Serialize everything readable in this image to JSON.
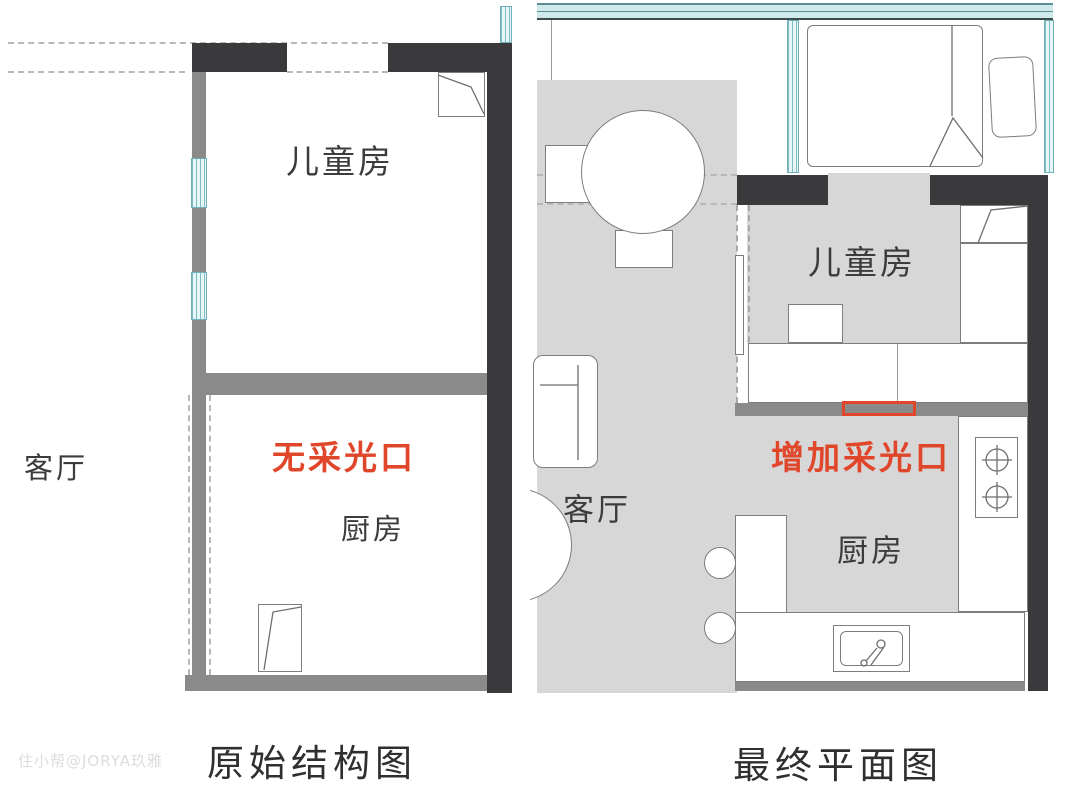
{
  "palette": {
    "wall_dark": "#3a3a3c",
    "wall_gray": "#8a8a8a",
    "floor_gray": "#d7d7d7",
    "window_teal": "#cfe9ea",
    "accent_red": "#e04629",
    "text_dark": "#3c3c3c"
  },
  "watermark": "住小帮@JORYA玖雅",
  "left_plan": {
    "caption": "原始结构图",
    "labels": {
      "living": "客厅",
      "kids_room": "儿童房",
      "kitchen": "厨房",
      "annotation": "无采光口"
    }
  },
  "right_plan": {
    "caption": "最终平面图",
    "labels": {
      "living": "客厅",
      "kids_room": "儿童房",
      "kitchen": "厨房",
      "annotation": "增加采光口"
    }
  }
}
